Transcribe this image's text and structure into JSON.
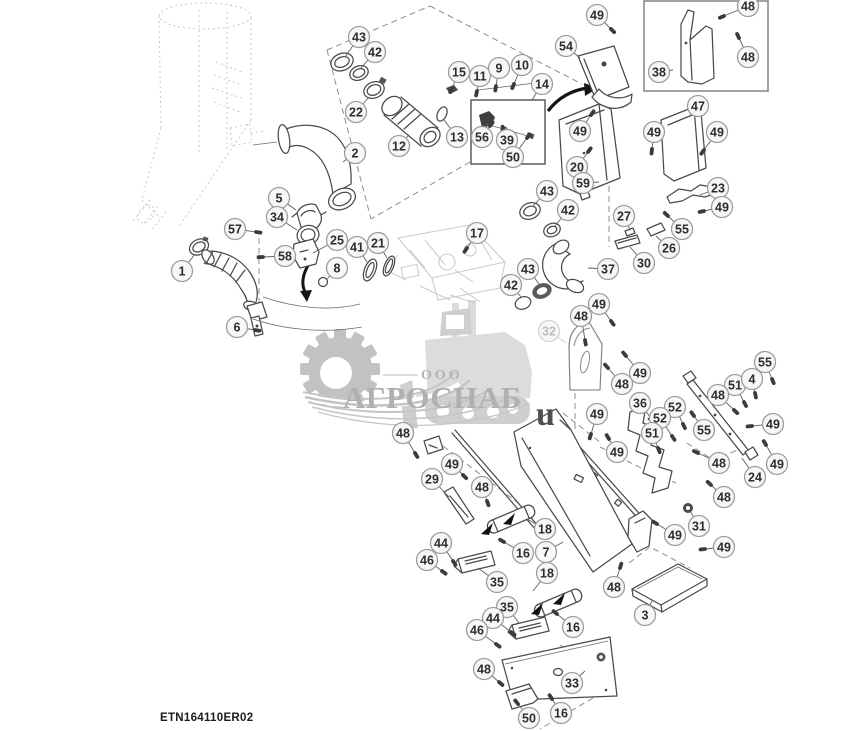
{
  "footer": {
    "drawing_code": "ETN164110ER02"
  },
  "watermark": {
    "org_type": "ООО",
    "name": "АГРОСНАБ",
    "letter_u": "u"
  },
  "styles": {
    "line": "#4a4a4a",
    "leader": "#5f5f5f",
    "balloon_fill": "#f7f7f7",
    "balloon_stroke": "#9c9c9c",
    "balloon_text": "#2d2d2d",
    "balloon_faded_stroke": "#d2d2d2",
    "balloon_faded_text": "#bcbcbc",
    "fastener": "#3b3b3b",
    "watermark_gray": "#c3c3c3"
  },
  "fasteners": [
    4,
    6,
    9,
    10,
    11,
    15,
    16,
    17,
    20,
    39,
    44,
    46,
    48,
    49,
    50,
    51,
    52,
    55,
    56,
    57,
    58
  ],
  "callouts": [
    {
      "n": "43",
      "x": 359,
      "y": 37,
      "tx": 345,
      "ty": 57
    },
    {
      "n": "42",
      "x": 375,
      "y": 52,
      "tx": 361,
      "ty": 68
    },
    {
      "n": "22",
      "x": 356,
      "y": 112,
      "tx": 369,
      "ty": 97
    },
    {
      "n": "12",
      "x": 399,
      "y": 146,
      "tx": 409,
      "ty": 135
    },
    {
      "n": "2",
      "x": 355,
      "y": 153,
      "tx": 343,
      "ty": 162
    },
    {
      "n": "5",
      "x": 279,
      "y": 198,
      "tx": 296,
      "ty": 210
    },
    {
      "n": "34",
      "x": 277,
      "y": 217,
      "tx": 297,
      "ty": 230
    },
    {
      "n": "57",
      "x": 235,
      "y": 229,
      "tx": 256,
      "ty": 232
    },
    {
      "n": "58",
      "x": 285,
      "y": 256,
      "tx": 263,
      "ty": 257
    },
    {
      "n": "25",
      "x": 337,
      "y": 240,
      "tx": 313,
      "ty": 253
    },
    {
      "n": "8",
      "x": 337,
      "y": 268,
      "tx": 327,
      "ty": 279
    },
    {
      "n": "41",
      "x": 357,
      "y": 247,
      "tx": 367,
      "ty": 262
    },
    {
      "n": "21",
      "x": 378,
      "y": 243,
      "tx": 387,
      "ty": 258
    },
    {
      "n": "1",
      "x": 182,
      "y": 271,
      "tx": 195,
      "ty": 254
    },
    {
      "n": "6",
      "x": 237,
      "y": 327,
      "tx": 255,
      "ty": 330
    },
    {
      "n": "49",
      "x": 597,
      "y": 15,
      "tx": 611,
      "ty": 29
    },
    {
      "n": "54",
      "x": 566,
      "y": 46,
      "tx": 580,
      "ty": 58
    },
    {
      "n": "48",
      "x": 748,
      "y": 6,
      "tx": 724,
      "ty": 16
    },
    {
      "n": "48",
      "x": 748,
      "y": 57,
      "tx": 739,
      "ty": 38
    },
    {
      "n": "38",
      "x": 659,
      "y": 72,
      "tx": 673,
      "ty": 70
    },
    {
      "n": "15",
      "x": 459,
      "y": 72,
      "tx": 452,
      "ty": 88
    },
    {
      "n": "11",
      "x": 480,
      "y": 76,
      "tx": 477,
      "ty": 91
    },
    {
      "n": "9",
      "x": 499,
      "y": 68,
      "tx": 496,
      "ty": 86
    },
    {
      "n": "10",
      "x": 522,
      "y": 65,
      "tx": 514,
      "ty": 84
    },
    {
      "n": "14",
      "x": 542,
      "y": 84,
      "tx": 532,
      "ty": 100
    },
    {
      "n": "13",
      "x": 457,
      "y": 137,
      "tx": 444,
      "ty": 120
    },
    {
      "n": "56",
      "x": 482,
      "y": 137,
      "tx": 490,
      "ty": 126
    },
    {
      "n": "39",
      "x": 507,
      "y": 140,
      "tx": 504,
      "ty": 131
    },
    {
      "n": "50",
      "x": 513,
      "y": 157,
      "tx": 527,
      "ty": 138
    },
    {
      "n": "47",
      "x": 698,
      "y": 106,
      "tx": 689,
      "ty": 117
    },
    {
      "n": "49",
      "x": 580,
      "y": 131,
      "tx": 591,
      "ty": 115
    },
    {
      "n": "49",
      "x": 654,
      "y": 132,
      "tx": 652,
      "ty": 149
    },
    {
      "n": "49",
      "x": 717,
      "y": 132,
      "tx": 704,
      "ty": 150
    },
    {
      "n": "20",
      "x": 577,
      "y": 167,
      "tx": 588,
      "ty": 152
    },
    {
      "n": "59",
      "x": 583,
      "y": 183,
      "tx": 599,
      "ty": 182
    },
    {
      "n": "23",
      "x": 718,
      "y": 188,
      "tx": 700,
      "ty": 195
    },
    {
      "n": "49",
      "x": 722,
      "y": 207,
      "tx": 704,
      "ty": 211
    },
    {
      "n": "55",
      "x": 682,
      "y": 229,
      "tx": 668,
      "ty": 216
    },
    {
      "n": "26",
      "x": 669,
      "y": 248,
      "tx": 656,
      "ty": 236
    },
    {
      "n": "27",
      "x": 624,
      "y": 216,
      "tx": 630,
      "ty": 230
    },
    {
      "n": "30",
      "x": 644,
      "y": 263,
      "tx": 630,
      "ty": 247
    },
    {
      "n": "43",
      "x": 547,
      "y": 191,
      "tx": 533,
      "ty": 206
    },
    {
      "n": "42",
      "x": 568,
      "y": 210,
      "tx": 555,
      "ty": 226
    },
    {
      "n": "37",
      "x": 608,
      "y": 269,
      "tx": 588,
      "ty": 268
    },
    {
      "n": "17",
      "x": 477,
      "y": 233,
      "tx": 467,
      "ty": 248
    },
    {
      "n": "43",
      "x": 528,
      "y": 269,
      "tx": 539,
      "ty": 284
    },
    {
      "n": "42",
      "x": 511,
      "y": 285,
      "tx": 521,
      "ty": 297
    },
    {
      "n": "32",
      "x": 549,
      "y": 331,
      "tx": 566,
      "ty": 343,
      "faded": true
    },
    {
      "n": "48",
      "x": 581,
      "y": 316,
      "tx": 585,
      "ty": 340
    },
    {
      "n": "49",
      "x": 599,
      "y": 304,
      "tx": 611,
      "ty": 321
    },
    {
      "n": "49",
      "x": 640,
      "y": 373,
      "tx": 626,
      "ty": 356
    },
    {
      "n": "48",
      "x": 622,
      "y": 384,
      "tx": 608,
      "ty": 368
    },
    {
      "n": "55",
      "x": 765,
      "y": 362,
      "tx": 772,
      "ty": 379
    },
    {
      "n": "51",
      "x": 735,
      "y": 385,
      "tx": 744,
      "ty": 402
    },
    {
      "n": "4",
      "x": 752,
      "y": 379,
      "tx": 755,
      "ty": 393
    },
    {
      "n": "48",
      "x": 718,
      "y": 395,
      "tx": 734,
      "ty": 410
    },
    {
      "n": "36",
      "x": 640,
      "y": 403,
      "tx": 650,
      "ty": 417
    },
    {
      "n": "52",
      "x": 675,
      "y": 407,
      "tx": 683,
      "ty": 424
    },
    {
      "n": "52",
      "x": 660,
      "y": 418,
      "tx": 672,
      "ty": 436
    },
    {
      "n": "55",
      "x": 704,
      "y": 430,
      "tx": 694,
      "ty": 416
    },
    {
      "n": "51",
      "x": 652,
      "y": 433,
      "tx": 658,
      "ty": 448
    },
    {
      "n": "49",
      "x": 773,
      "y": 424,
      "tx": 752,
      "ty": 426
    },
    {
      "n": "49",
      "x": 597,
      "y": 414,
      "tx": 591,
      "ty": 434
    },
    {
      "n": "49",
      "x": 617,
      "y": 452,
      "tx": 609,
      "ty": 439
    },
    {
      "n": "48",
      "x": 719,
      "y": 463,
      "tx": 698,
      "ty": 453
    },
    {
      "n": "24",
      "x": 755,
      "y": 477,
      "tx": 742,
      "ty": 458
    },
    {
      "n": "49",
      "x": 777,
      "y": 464,
      "tx": 766,
      "ty": 445
    },
    {
      "n": "48",
      "x": 724,
      "y": 497,
      "tx": 711,
      "ty": 485
    },
    {
      "n": "31",
      "x": 699,
      "y": 526,
      "tx": 690,
      "ty": 511
    },
    {
      "n": "49",
      "x": 675,
      "y": 535,
      "tx": 657,
      "ty": 524
    },
    {
      "n": "49",
      "x": 724,
      "y": 547,
      "tx": 705,
      "ty": 549
    },
    {
      "n": "3",
      "x": 645,
      "y": 615,
      "tx": 652,
      "ty": 601
    },
    {
      "n": "48",
      "x": 403,
      "y": 433,
      "tx": 415,
      "ty": 453
    },
    {
      "n": "29",
      "x": 432,
      "y": 479,
      "tx": 449,
      "ty": 497
    },
    {
      "n": "49",
      "x": 452,
      "y": 464,
      "tx": 463,
      "ty": 475
    },
    {
      "n": "48",
      "x": 482,
      "y": 487,
      "tx": 487,
      "ty": 501
    },
    {
      "n": "18",
      "x": 545,
      "y": 529,
      "tx": 527,
      "ty": 519
    },
    {
      "n": "16",
      "x": 523,
      "y": 553,
      "tx": 504,
      "ty": 542
    },
    {
      "n": "7",
      "x": 546,
      "y": 552,
      "tx": 563,
      "ty": 542
    },
    {
      "n": "44",
      "x": 441,
      "y": 543,
      "tx": 453,
      "ty": 561
    },
    {
      "n": "46",
      "x": 427,
      "y": 560,
      "tx": 442,
      "ty": 571
    },
    {
      "n": "35",
      "x": 497,
      "y": 582,
      "tx": 478,
      "ty": 568
    },
    {
      "n": "18",
      "x": 547,
      "y": 573,
      "tx": 533,
      "ty": 591
    },
    {
      "n": "35",
      "x": 507,
      "y": 607,
      "tx": 519,
      "ty": 623
    },
    {
      "n": "44",
      "x": 493,
      "y": 618,
      "tx": 511,
      "ty": 632
    },
    {
      "n": "46",
      "x": 477,
      "y": 630,
      "tx": 496,
      "ty": 644
    },
    {
      "n": "16",
      "x": 573,
      "y": 627,
      "tx": 557,
      "ty": 614
    },
    {
      "n": "33",
      "x": 572,
      "y": 683,
      "tx": 585,
      "ty": 671
    },
    {
      "n": "48",
      "x": 484,
      "y": 669,
      "tx": 499,
      "ty": 682
    },
    {
      "n": "50",
      "x": 529,
      "y": 718,
      "tx": 518,
      "ty": 704
    },
    {
      "n": "16",
      "x": 561,
      "y": 713,
      "tx": 552,
      "ty": 699
    },
    {
      "n": "48",
      "x": 614,
      "y": 587,
      "tx": 620,
      "ty": 568
    }
  ]
}
